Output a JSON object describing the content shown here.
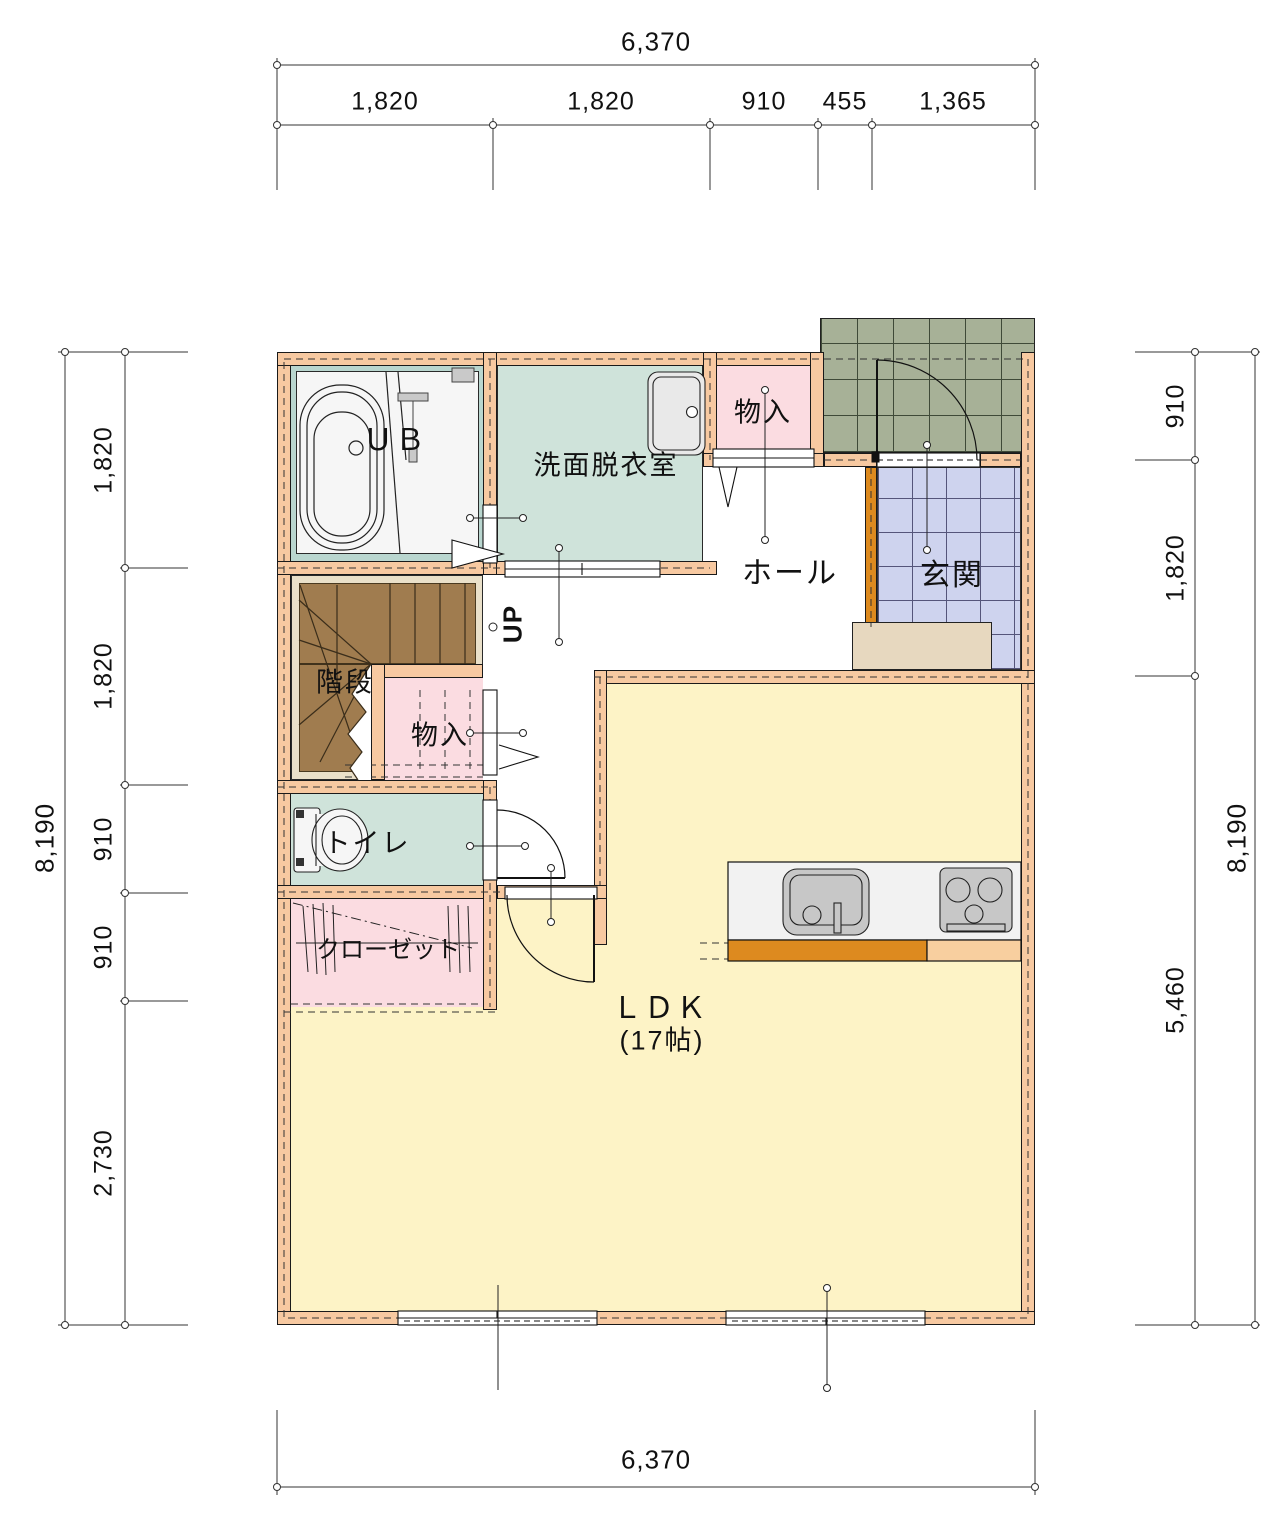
{
  "rooms": {
    "ub": {
      "label": "ＵＢ"
    },
    "washroom": {
      "label": "洗面脱衣室"
    },
    "storage_top": {
      "label": "物入"
    },
    "hall": {
      "label": "ホール"
    },
    "entrance": {
      "label": "玄関"
    },
    "stairs": {
      "label": "階段",
      "direction": "UP"
    },
    "storage_mid": {
      "label": "物入"
    },
    "toilet": {
      "label": "トイレ"
    },
    "closet": {
      "label": "クローゼット"
    },
    "ldk": {
      "label": "ＬＤＫ",
      "area": "(17帖)"
    }
  },
  "dims": {
    "top": {
      "total": "6,370",
      "segments": [
        "1,820",
        "1,820",
        "910",
        "455",
        "1,365"
      ]
    },
    "bottom": {
      "total": "6,370"
    },
    "left": {
      "total": "8,190",
      "segments": [
        "1,820",
        "1,820",
        "910",
        "910",
        "2,730"
      ]
    },
    "right": {
      "total": "8,190",
      "segments": [
        "910",
        "1,820",
        "5,460"
      ]
    }
  },
  "colors": {
    "wall": "#f7c9a1",
    "wall_accent": "#dd8a1f",
    "ldk_floor": "#fdf3c6",
    "wet_room_floor": "#cfe3da",
    "ub_frame": "#b9d6cf",
    "storage_floor": "#fbdce1",
    "stairs_brown": "#a07c4f",
    "stairs_trim": "#eae0c9",
    "entrance_tile": "#ced3ee",
    "porch_tile": "#a7b197",
    "entrance_step": "#e7d8bf",
    "fixture_gray": "#c7c7c7",
    "line": "#1a1a1a"
  }
}
